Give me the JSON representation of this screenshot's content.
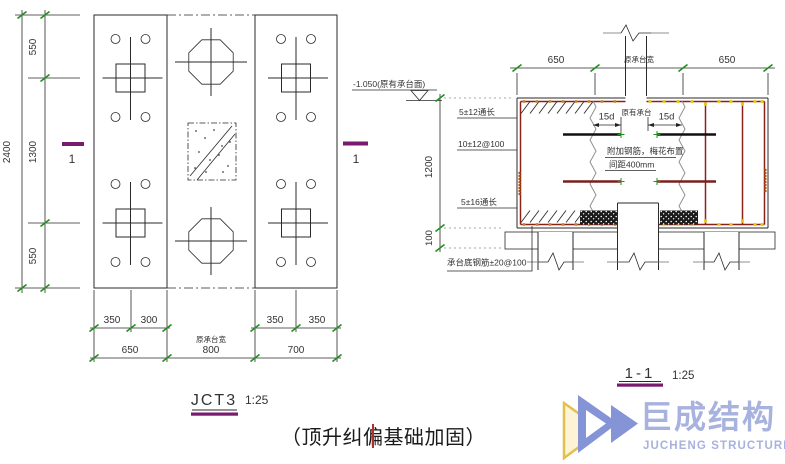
{
  "plan": {
    "title": "JCT3",
    "scale": "1:25",
    "section_mark": "1",
    "dim_total": "2400",
    "dim_rows_left": [
      "550",
      "1300",
      "550"
    ],
    "dim_row1": [
      "350",
      "300",
      "350",
      "350"
    ],
    "dim_row2": [
      "650",
      "800",
      "700"
    ],
    "dim_row2_note": "原承台宽"
  },
  "section": {
    "title": "1-1",
    "scale": "1:25",
    "elevation": "-1.050(原有承台面)",
    "dim_top": [
      "650",
      "650"
    ],
    "dim_top_note": "原承台宽",
    "dim_height": "1200",
    "dim_cushion": "100",
    "dim_anchor": "15d",
    "label_top_bars": "5±12通长",
    "label_side_bars": "10±12@100",
    "label_bottom_bars": "5±16通长",
    "label_existing_cap": "原有承台",
    "note_added_rebar": "附加钢筋，梅花布置",
    "note_spacing": "间距400mm",
    "label_cap_bottom_rebar": "承台底钢筋±20@100"
  },
  "caption": "（顶升纠偏基础加固）",
  "logo": {
    "name": "巨成结构",
    "subtitle": "JUCHENG STRUCTURE"
  },
  "colors": {
    "line": "#2a2a2a",
    "rebar_outline": "#8a2118",
    "section_mark_purple": "#7a1a6e",
    "tick_green": "#1f8f1f",
    "rebar_dot_yellow": "#e6c81e",
    "rebar_dot_orange": "#c07828",
    "cursor_red": "#b03030",
    "logo_blue": "#a8b2de",
    "logo_yellow": "#e3bf4e"
  }
}
